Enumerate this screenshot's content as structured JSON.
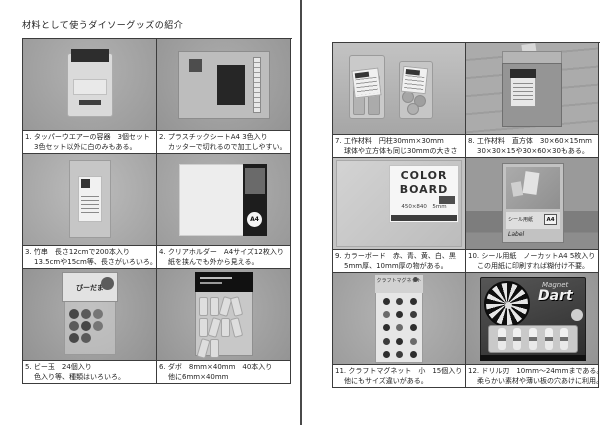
{
  "title": "材料として使うダイソーグッズの紹介",
  "colors": {
    "table_border": "#3c3c3c",
    "divider": "#4a4a4a",
    "text": "#1e1e1e"
  },
  "pages": [
    {
      "side": "left",
      "items": [
        {
          "photo": "tupperware-container",
          "line1": "1. タッパーウエアーの容器　3個セット",
          "line2": "3色セット以外に白のみもある。"
        },
        {
          "photo": "plastic-sheet",
          "line1": "2. プラスチックシートA4 3色入り",
          "line2": "カッターで切れるので加工しやすい。"
        },
        {
          "photo": "bamboo-skewers",
          "line1": "3. 竹串　長さ12cmで200本入り",
          "line2": "13.5cmや15cm等、長さがいろいろ。"
        },
        {
          "photo": "clear-holder",
          "line1": "4. クリアホルダー　A4サイズ12枚入り",
          "line2": "紙を挟んでも外から見える。",
          "photo_text": "A4"
        },
        {
          "photo": "marbles",
          "line1": "5. ビー玉　24個入り",
          "line2": "色入り等、種類はいろいろ。",
          "photo_text": "びーだま"
        },
        {
          "photo": "dowels",
          "line1": "6. ダボ　8mm×40mm　40本入り",
          "line2": "他に6mm×40mm"
        }
      ]
    },
    {
      "side": "right",
      "items": [
        {
          "photo": "wood-cylinders",
          "line1": "7. 工作材料　円柱30mm×30mm",
          "line2": "球体や立方体も同じ30mmの大きさ"
        },
        {
          "photo": "wood-blocks",
          "line1": "8. 工作材料　直方体　30×60×15mm",
          "line2": "30×30×15や30×60×30もある。"
        },
        {
          "photo": "color-board",
          "line1": "9. カラーボード　赤、青、黄、白、黒",
          "line2": "5mm厚、10mm厚の物がある。",
          "photo_text": "COLOR",
          "photo_text2": "BOARD",
          "photo_text3": "450×840　5mm"
        },
        {
          "photo": "seal-paper",
          "line1": "10. シール用紙　ノーカットA4 5枚入り",
          "line2": "この用紙に印刷すれば糊付け不要。",
          "photo_text": "シール用紙",
          "photo_text2": "A4",
          "photo_text3": "Label"
        },
        {
          "photo": "craft-magnets",
          "line1": "11. クラフトマグネット　小　15個入り",
          "line2": "他にもサイズ違いがある。",
          "photo_text": "クラフトマグネット"
        },
        {
          "photo": "magnet-dart",
          "line1": "12. ドリル刃　10mm～24mmまである。",
          "line2": "柔らかい素材や薄い板の穴あけに利用。",
          "photo_text": "Magnet",
          "photo_text2": "Dart"
        }
      ]
    }
  ]
}
